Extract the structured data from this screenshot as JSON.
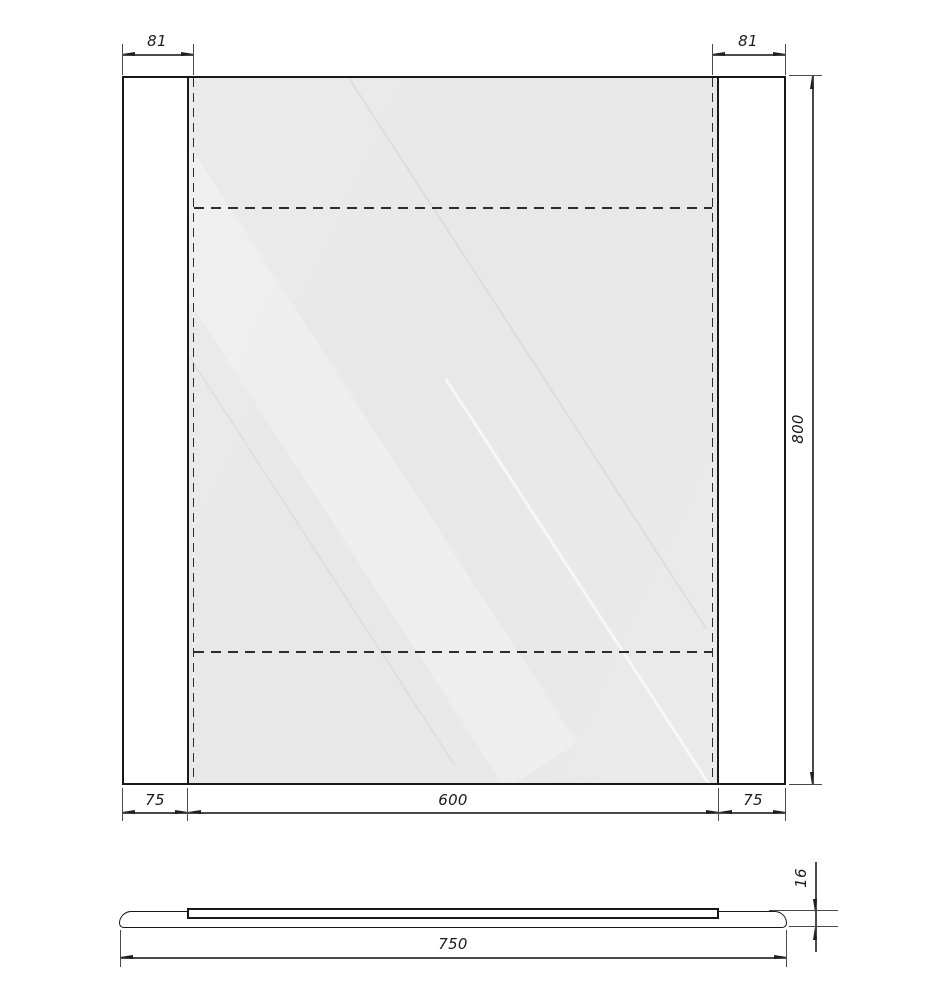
{
  "front": {
    "dim_top_left": "81",
    "dim_top_right": "81",
    "dim_height": "800",
    "dim_bottom_left": "75",
    "dim_bottom_center": "600",
    "dim_bottom_right": "75"
  },
  "side": {
    "dim_width": "750",
    "dim_thickness": "16"
  },
  "colors": {
    "line": "#181818",
    "dim_line": "#4a4a4a",
    "glass_fill": "#e9e9e9",
    "background": "#ffffff"
  }
}
